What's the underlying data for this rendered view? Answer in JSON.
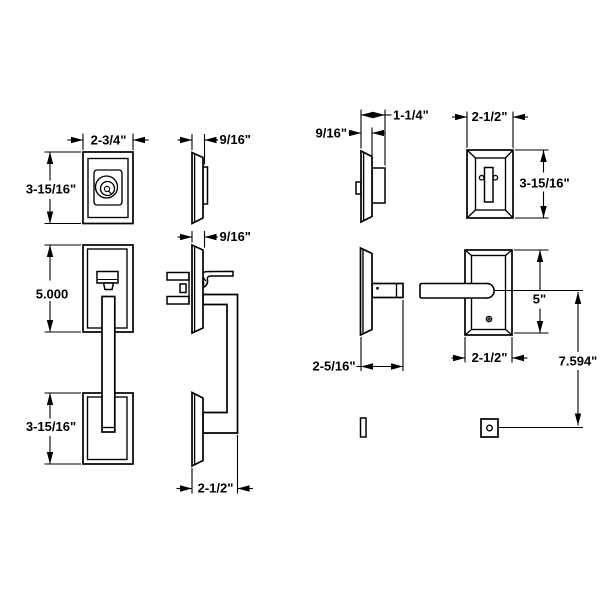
{
  "drawing": {
    "background_color": "#ffffff",
    "line_color": "#000000",
    "labels": {
      "exterior_rose_width": "2-3/4\"",
      "exterior_rose_height": "3-15/16\"",
      "exterior_rose_thickness": "9/16\"",
      "grip_rose_thickness": "9/16\"",
      "grip_plate_height": "5.000",
      "grip_bottom_height": "3-15/16\"",
      "grip_projection": "2-1/2\"",
      "interior_bolt_projection": "1-1/4\"",
      "interior_bolt_thickness": "9/16\"",
      "interior_bolt_width": "2-1/2\"",
      "interior_bolt_height": "3-15/16\"",
      "lever_projection": "2-5/16\"",
      "lever_rose_width": "2-1/2\"",
      "lever_rose_height": "5\"",
      "lever_to_bolt_offset": "7.594\""
    }
  }
}
